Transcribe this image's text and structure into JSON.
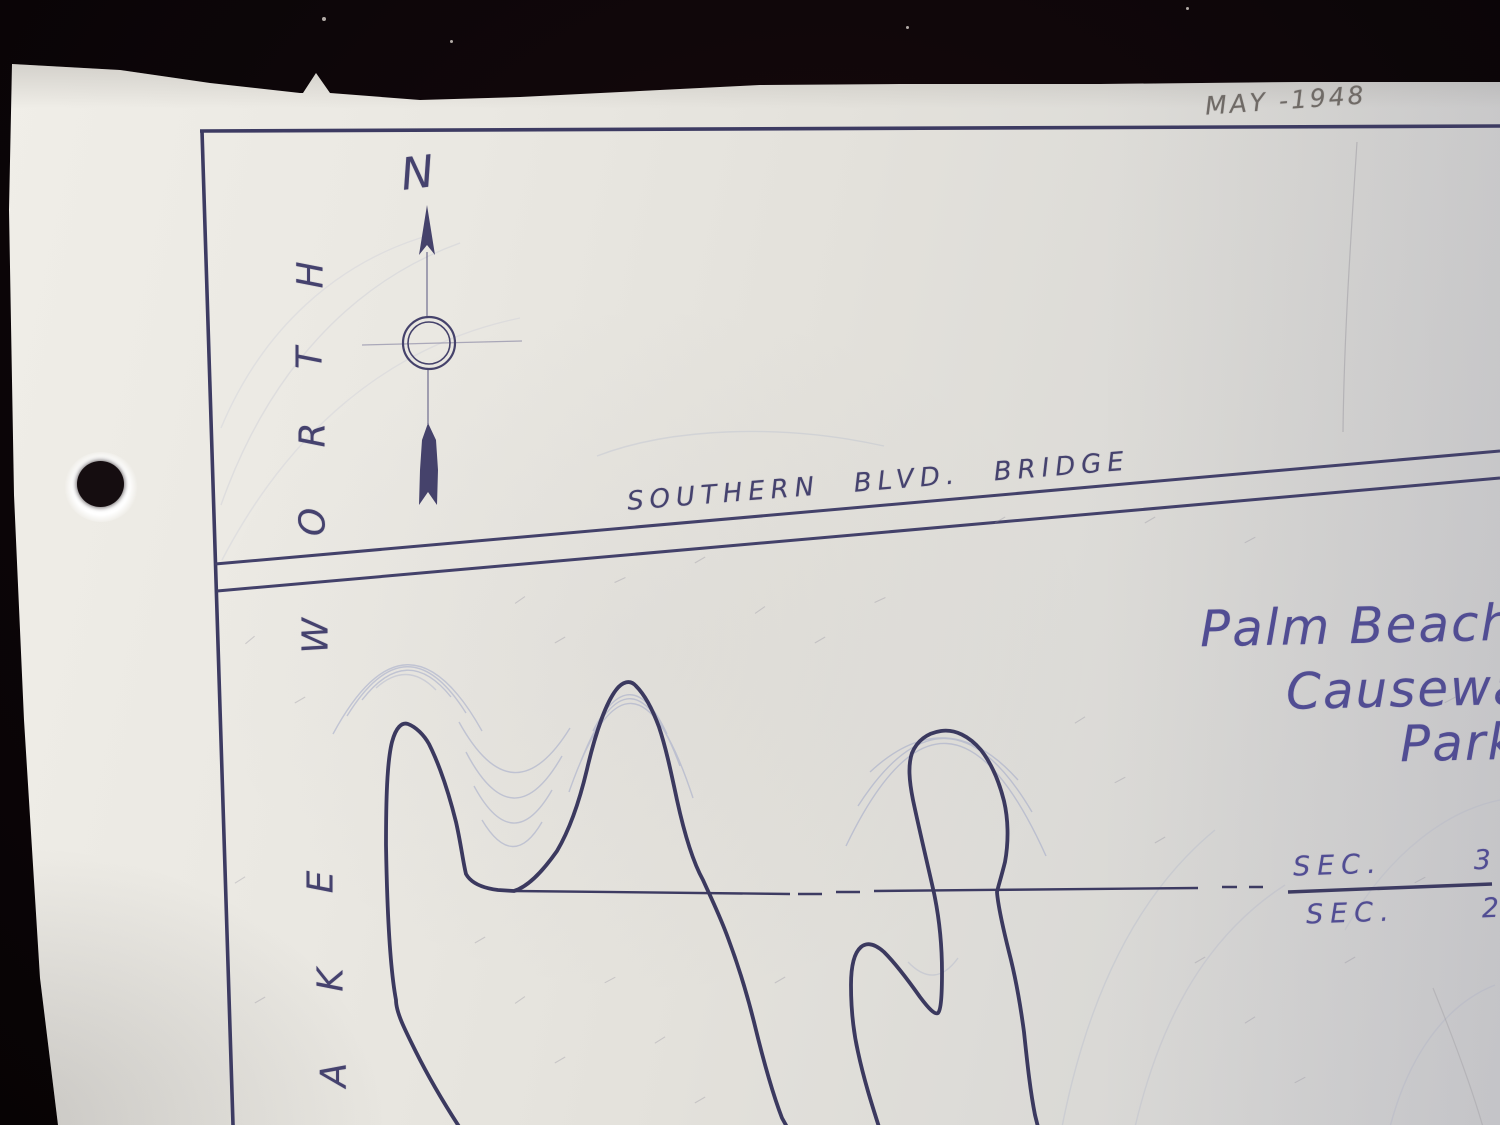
{
  "photo": {
    "background_color": "#0d0609",
    "paper_color": "#e7e5df",
    "pencil_note": "MAY -1948"
  },
  "map": {
    "ink_color": "#403e68",
    "text_ink_color": "#514d93",
    "contour_color": "#9aa3c6",
    "compass": {
      "north_label": "N"
    },
    "bridge": {
      "label_words": [
        "SOUTHERN",
        "BLVD.",
        "BRIDGE"
      ]
    },
    "title": {
      "line1": "Palm Beach",
      "line2": "Causeway",
      "line3": "Park"
    },
    "section_marker": {
      "top_label": "SEC.",
      "top_number": "3",
      "bottom_label": "SEC.",
      "bottom_number": "2"
    },
    "water_label": {
      "letters": [
        "H",
        "T",
        "R",
        "O",
        "W",
        "E",
        "K",
        "A"
      ]
    }
  }
}
